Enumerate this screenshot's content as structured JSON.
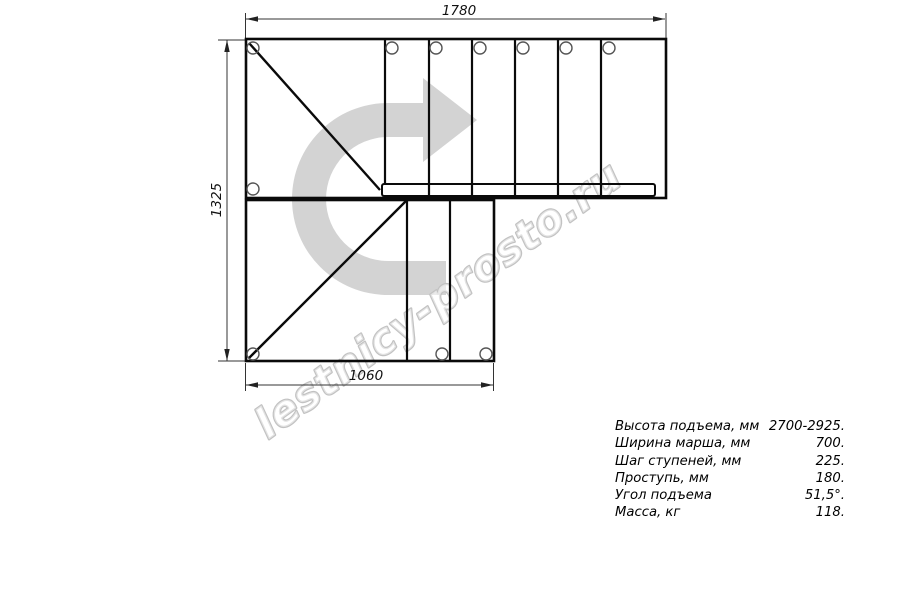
{
  "drawing": {
    "title": "stair-plan-top-view",
    "dim_top": "1780",
    "dim_left": "1325",
    "dim_bottom": "1060"
  },
  "watermark": {
    "text": "lestnicy-prosto.ru"
  },
  "specs": {
    "rows": [
      {
        "label": "Высота подъема, мм",
        "value": "2700-2925."
      },
      {
        "label": "Ширина марша, мм",
        "value": "700."
      },
      {
        "label": "Шаг ступеней, мм",
        "value": "225."
      },
      {
        "label": "Проступь, мм",
        "value": "180."
      },
      {
        "label": "Угол подъема",
        "value": "51,5°."
      },
      {
        "label": "Масса, кг",
        "value": "118."
      }
    ]
  },
  "colors": {
    "arrow_fill": "#d3d3d3",
    "watermark_stroke": "#c2c2c2",
    "line": "#0a0a0a",
    "dim_line": "#222222"
  }
}
